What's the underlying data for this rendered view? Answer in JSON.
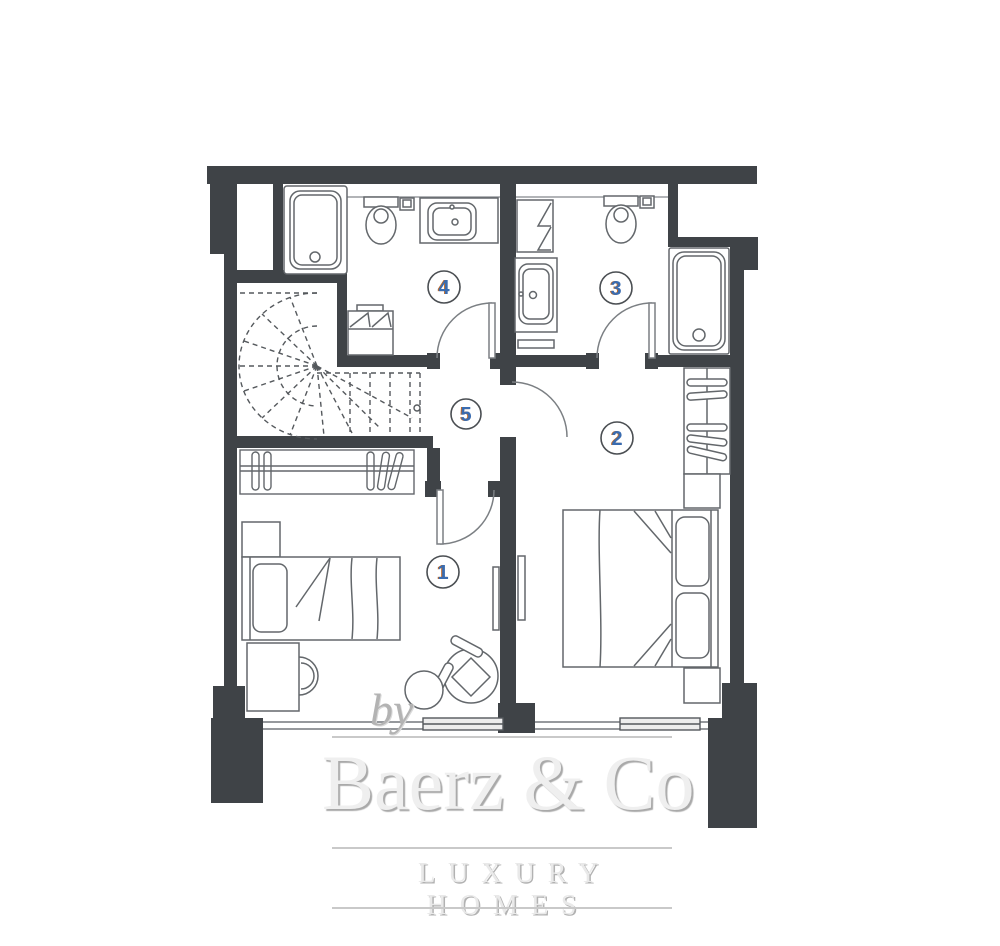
{
  "plan": {
    "room_labels": [
      {
        "number": "1"
      },
      {
        "number": "2"
      },
      {
        "number": "3"
      },
      {
        "number": "4"
      },
      {
        "number": "5"
      }
    ]
  },
  "watermark": {
    "by_text": "by",
    "brand": "Baerz & Co",
    "tagline": "LUXURY HOMES"
  },
  "colors": {
    "wall": "#3f4347",
    "fixture_line": "#63676b",
    "door_arc": "#7b7f83",
    "stair_dash": "#55595d",
    "label_number": "#3a6cb0",
    "label_number_fringe": "#c06a28",
    "label_circle_outline": "#4a4e52",
    "sill_line": "#96999d",
    "window_frame_fill": "#ededed",
    "watermark_text": "#efefef",
    "watermark_shadow": "#a9a9a9",
    "watermark_rule": "#c9c9c9",
    "by_text": "#b3b3b3"
  }
}
